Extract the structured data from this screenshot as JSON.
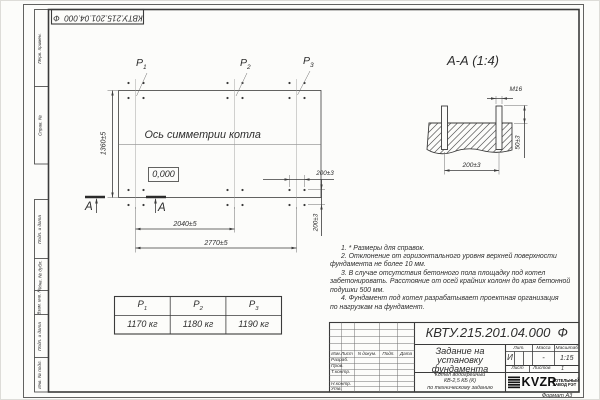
{
  "page": {
    "format_note": "Формат А3"
  },
  "stamps": {
    "doc_number": "КВТУ.215.201.04.000  Ф"
  },
  "margin_labels": {
    "upper": [
      "Перв. примен.",
      "Справ. №"
    ],
    "lower": [
      "Подп. и дата",
      "Инв. № дубл.",
      "Взам. инв. №",
      "Подп. и дата",
      "Инв. № подл."
    ]
  },
  "plan": {
    "load_points": [
      {
        "base": "P",
        "sub": "1"
      },
      {
        "base": "P",
        "sub": "2"
      },
      {
        "base": "P",
        "sub": "3"
      }
    ],
    "axis_label": "Ось симметрии котла",
    "level_mark": "0,000",
    "dims": {
      "height": "1360±5",
      "inner_width": "2040±5",
      "total_width": "2770±5",
      "bolt_x": "200±3",
      "bolt_y": "200±3"
    },
    "section_letter": "А"
  },
  "section": {
    "title": "А-А (1:4)",
    "thread": "М16",
    "protrusion": "50±3",
    "bolt_spacing": "200±3"
  },
  "notes": {
    "lines": [
      "1. * Размеры для справок.",
      "2. Отклонение от горизонтального уровня верхней поверхности",
      "фундамента не более 10 мм.",
      "3. В случае отсутствия бетонного пола площадку под котел",
      "забетонировать. Расстояние от осей крайних колонн до края бетонной",
      "подушки 500 мм.",
      "4. Фундамент под котел разрабатывает проектная организация",
      "по нагрузкам на фундамент."
    ]
  },
  "load_table": {
    "values": [
      "1170 кг",
      "1180 кг",
      "1190 кг"
    ]
  },
  "title_block": {
    "title_lines": [
      "Задание на",
      "установку",
      "фундамента"
    ],
    "product_lines": [
      "Котел водогрейный",
      "КВ-2,5 КБ (К)",
      "по техническому заданию"
    ],
    "lit_header": "Лит.",
    "mass_header": "Масса",
    "scale_header": "Масштаб",
    "lit_value": "И",
    "mass_value": "-",
    "scale_value": "1:15",
    "sheet_label": "Лист",
    "sheets_label": "Листов",
    "sheets_value": "1",
    "sign_cols": {
      "izm": "Изм.Лист",
      "doc": "N докум.",
      "sign": "Подп.",
      "date": "Дата"
    },
    "sign_rows": [
      "Разраб.",
      "Пров.",
      "Т.контр.",
      "Н.контр.",
      "Утв."
    ],
    "logo": {
      "text": "KVZR",
      "sub_lines": [
        "КОТЕЛЬНЫЙ",
        "ЗАВОД РЭТ"
      ]
    }
  }
}
